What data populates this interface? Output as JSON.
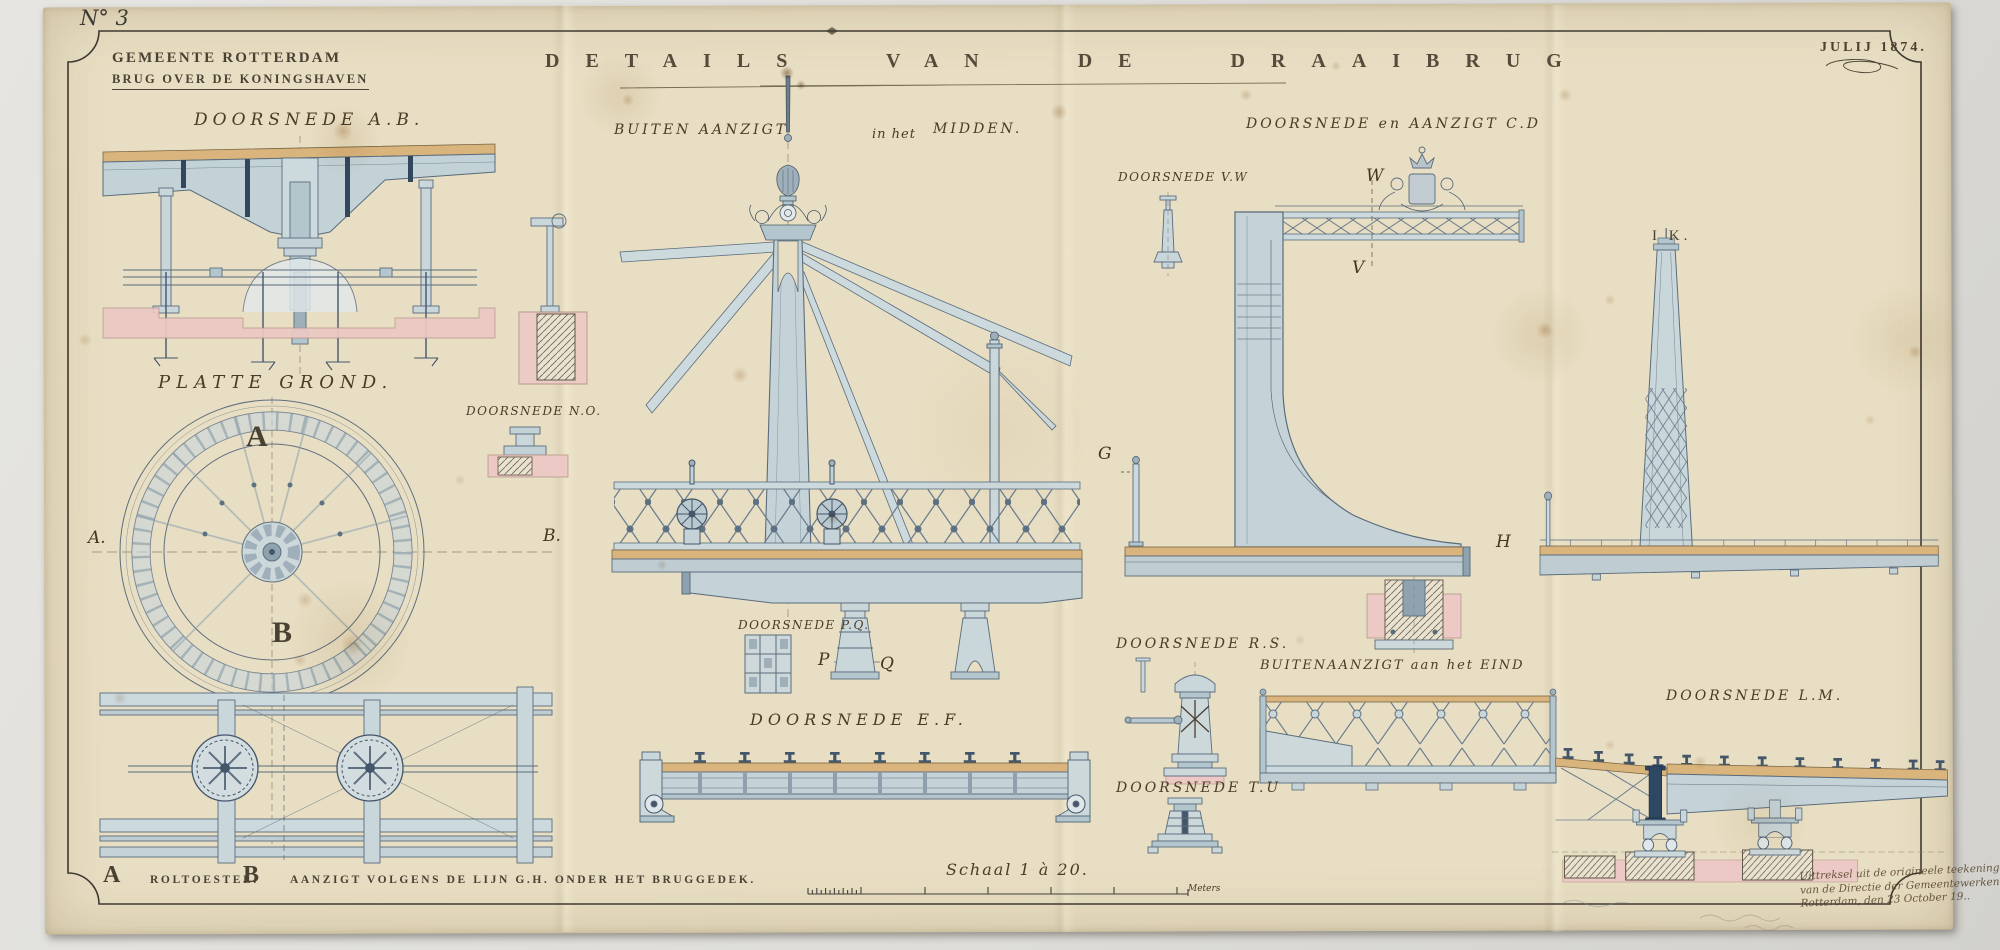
{
  "sheet": {
    "number": "N° 3",
    "agency": "GEMEENTE ROTTERDAM",
    "subtitle": "BRUG OVER DE KONINGSHAVEN",
    "title": "DETAILS VAN DE DRAAIBRUG",
    "date": "JULIJ 1874."
  },
  "labels": {
    "ab": "DOORSNEDE A.B.",
    "platte_grond": "PLATTE GROND.",
    "no": "DOORSNEDE N.O.",
    "buiten_midden_a": "BUITEN AANZIGT",
    "buiten_midden_b": "in het",
    "buiten_midden_c": "MIDDEN.",
    "vw": "DOORSNEDE V.W",
    "cd": "DOORSNEDE en AANZIGT C.D",
    "ik": "I K.",
    "pq": "DOORSNEDE P.Q.",
    "ef": "DOORSNEDE E.F.",
    "rs": "DOORSNEDE R.S.",
    "tu": "DOORSNEDE T.U",
    "eind": "BUITENAANZIGT aan het EIND",
    "lm": "DOORSNEDE L.M."
  },
  "markers": {
    "plan_a": "A",
    "plan_b": "B",
    "line_a": "A.",
    "line_b": "B.",
    "g": "G",
    "h": "H",
    "v": "V",
    "w": "W",
    "p": "P",
    "q": "Q"
  },
  "legend": {
    "a_key": "A",
    "a_text": "ROLTOESTEL.",
    "b_key": "B",
    "b_text": "AANZIGT VOLGENS DE LIJN G.H. ONDER HET BRUGGEDEK.",
    "scale": "Schaal 1 à 20.",
    "scale_unit": "Meters"
  },
  "annotation": {
    "line1": "Uittreksel uit de origineele teekeningen",
    "line2": "van de Directie der Gemeentewerken",
    "line3": "Rotterdam, den 23 October 19.."
  },
  "colors": {
    "paper": "#e8dec3",
    "ink": "#4b4133",
    "drawing_stroke": "#5a6c7c",
    "drawing_fill": "#c5d3d8",
    "deck_tan": "#d9b47c",
    "masonry_pink": "#ecc9c4",
    "accent_navy": "#2e4763"
  }
}
